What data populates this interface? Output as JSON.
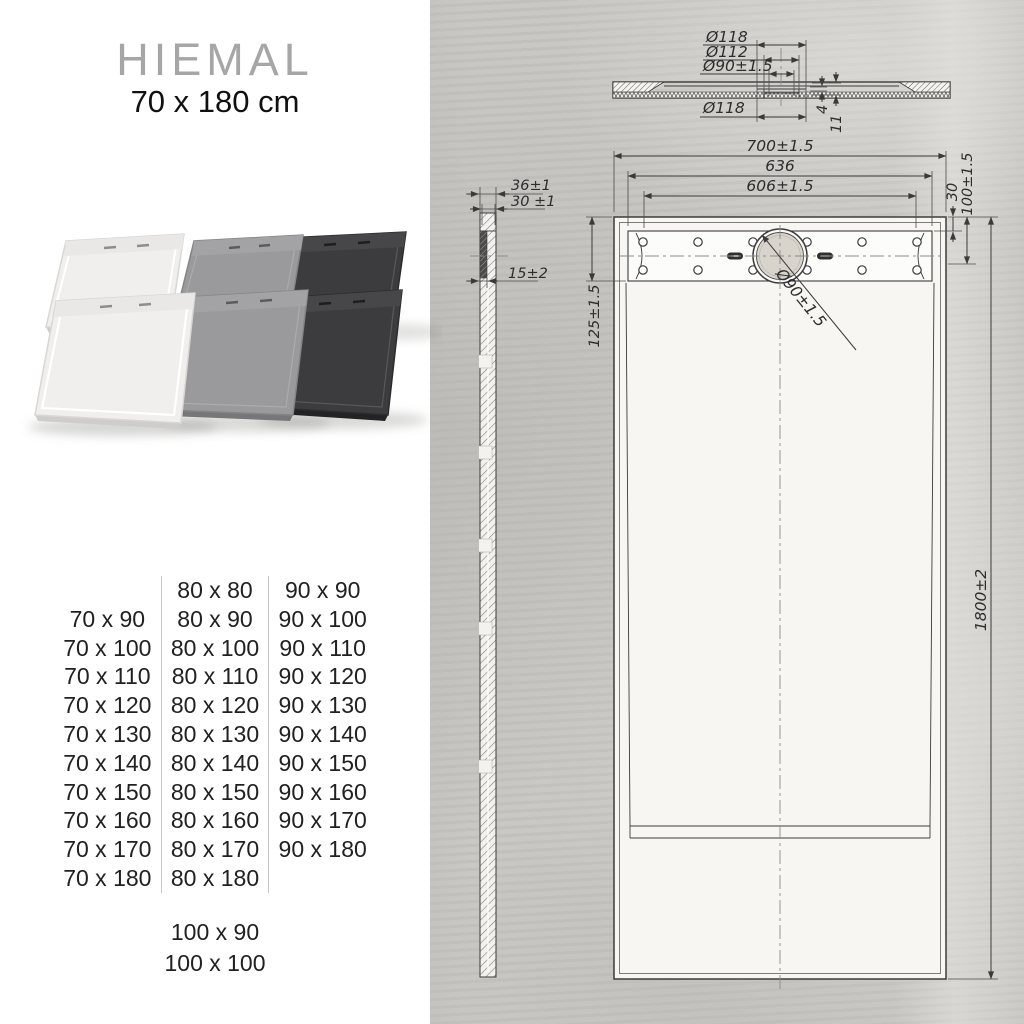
{
  "product": {
    "title": "HIEMAL",
    "subtitle": "70 x 180 cm"
  },
  "photo": {
    "tray_colors": {
      "white": "#f0efed",
      "grey": "#9a9a9c",
      "anthracite": "#3c3c3f"
    }
  },
  "sizes": {
    "col_70": [
      "70 x 90",
      "70 x 100",
      "70 x 110",
      "70 x 120",
      "70 x 130",
      "70 x 140",
      "70 x 150",
      "70 x 160",
      "70 x 170",
      "70 x 180"
    ],
    "col_80": [
      "80 x 80",
      "80 x 90",
      "80 x 100",
      "80 x 110",
      "80 x 120",
      "80 x 130",
      "80 x 140",
      "80 x 150",
      "80 x 160",
      "80 x 170",
      "80 x 180"
    ],
    "col_90": [
      "90 x 90",
      "90 x 100",
      "90 x 110",
      "90 x 120",
      "90 x 130",
      "90 x 140",
      "90 x 150",
      "90 x 160",
      "90 x 170",
      "90 x 180"
    ],
    "extra": [
      "100 x 90",
      "100 x 100"
    ]
  },
  "drawing": {
    "section": {
      "dia118_top": "Ø118",
      "dia112": "Ø112",
      "dia90": "Ø90±1.5",
      "dia118_bottom": "Ø118",
      "depth4": "4",
      "depth11": "11"
    },
    "plan": {
      "width_overall": "700±1.5",
      "width_outer": "636",
      "width_inner": "606±1.5",
      "offset30": "30",
      "offset100": "100±1.5",
      "offset125": "125±1.5",
      "drain_dia": "Ø90±1.5",
      "length_overall": "1800±2"
    },
    "side": {
      "w36": "36±1",
      "w30": "30 ±1",
      "w15": "15±2"
    }
  },
  "colors": {
    "concrete": "#c7c5c1",
    "drawing_line": "#3c3c3c",
    "title_grey": "#a6a6a6",
    "text": "#212121"
  }
}
